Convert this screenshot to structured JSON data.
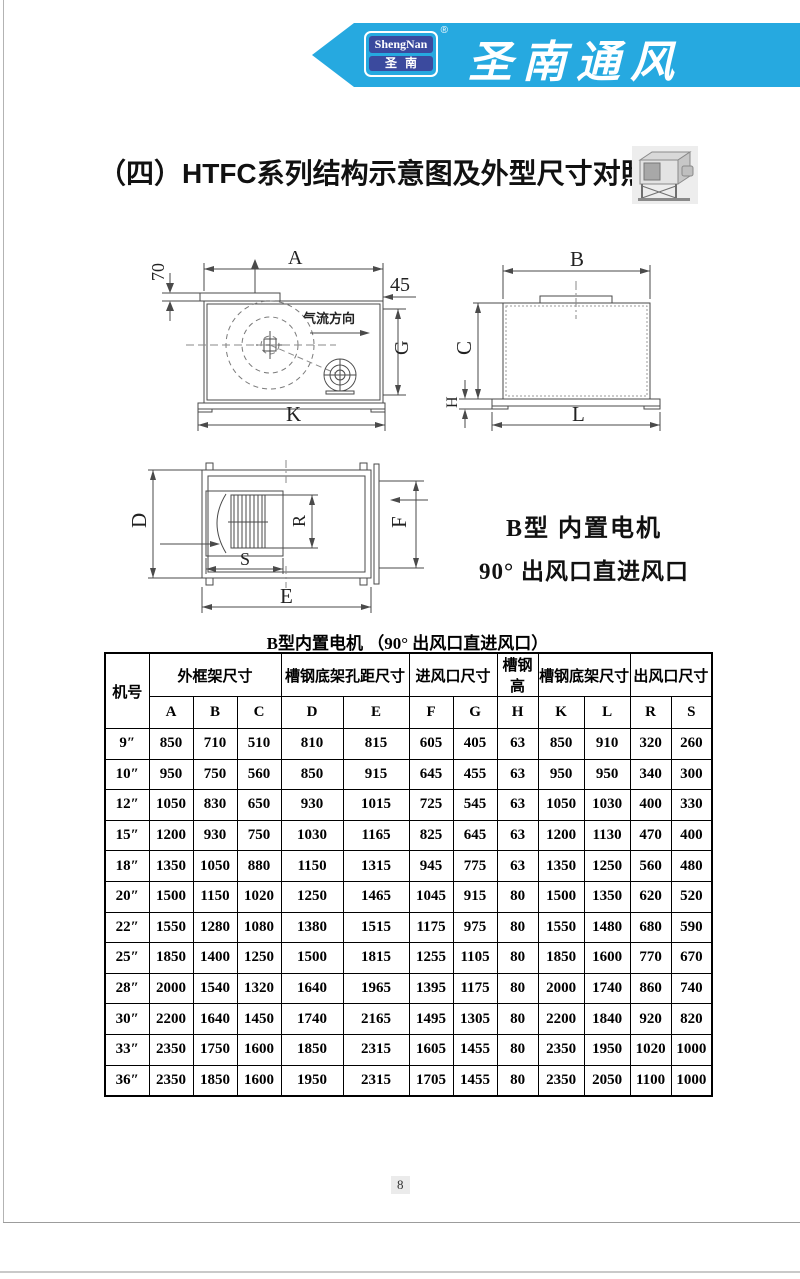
{
  "header": {
    "banner_color": "#26a9e0",
    "logo": {
      "line1": "ShengNan",
      "line2": "圣南",
      "registered": "®",
      "box_color": "#3b4a9e"
    },
    "brand": "圣南通风"
  },
  "title": "（四）HTFC系列结构示意图及外型尺寸对照表",
  "diagrams": {
    "side_view": {
      "dim_top": "A",
      "dim_flange": "70",
      "dim_outlet_gap": "45",
      "dim_right": "G",
      "dim_bottom": "K",
      "airflow": "气流方向"
    },
    "front_view": {
      "dim_top": "B",
      "dim_left": "C",
      "dim_base": "H",
      "dim_bottom": "L"
    },
    "plan_view": {
      "dim_left": "D",
      "dim_wheel_h": "R",
      "dim_wheel_w": "S",
      "dim_right": "F",
      "dim_bottom": "E"
    },
    "type_note_line1": "B型  内置电机",
    "type_note_line2": "90° 出风口直进风口"
  },
  "table": {
    "title": "B型内置电机 （90° 出风口直进风口）",
    "col_machine": "机号",
    "groups": [
      {
        "label": "外框架尺寸",
        "span": 3
      },
      {
        "label": "槽钢底架孔距尺寸",
        "span": 2
      },
      {
        "label": "进风口尺寸",
        "span": 2
      },
      {
        "label": "槽钢高",
        "span": 1
      },
      {
        "label": "槽钢底架尺寸",
        "span": 2
      },
      {
        "label": "出风口尺寸",
        "span": 2
      }
    ],
    "letters": [
      "A",
      "B",
      "C",
      "D",
      "E",
      "F",
      "G",
      "H",
      "K",
      "L",
      "R",
      "S"
    ],
    "rows": [
      {
        "model": "9″",
        "values": [
          "850",
          "710",
          "510",
          "810",
          "815",
          "605",
          "405",
          "63",
          "850",
          "910",
          "320",
          "260"
        ]
      },
      {
        "model": "10″",
        "values": [
          "950",
          "750",
          "560",
          "850",
          "915",
          "645",
          "455",
          "63",
          "950",
          "950",
          "340",
          "300"
        ]
      },
      {
        "model": "12″",
        "values": [
          "1050",
          "830",
          "650",
          "930",
          "1015",
          "725",
          "545",
          "63",
          "1050",
          "1030",
          "400",
          "330"
        ]
      },
      {
        "model": "15″",
        "values": [
          "1200",
          "930",
          "750",
          "1030",
          "1165",
          "825",
          "645",
          "63",
          "1200",
          "1130",
          "470",
          "400"
        ]
      },
      {
        "model": "18″",
        "values": [
          "1350",
          "1050",
          "880",
          "1150",
          "1315",
          "945",
          "775",
          "63",
          "1350",
          "1250",
          "560",
          "480"
        ]
      },
      {
        "model": "20″",
        "values": [
          "1500",
          "1150",
          "1020",
          "1250",
          "1465",
          "1045",
          "915",
          "80",
          "1500",
          "1350",
          "620",
          "520"
        ]
      },
      {
        "model": "22″",
        "values": [
          "1550",
          "1280",
          "1080",
          "1380",
          "1515",
          "1175",
          "975",
          "80",
          "1550",
          "1480",
          "680",
          "590"
        ]
      },
      {
        "model": "25″",
        "values": [
          "1850",
          "1400",
          "1250",
          "1500",
          "1815",
          "1255",
          "1105",
          "80",
          "1850",
          "1600",
          "770",
          "670"
        ]
      },
      {
        "model": "28″",
        "values": [
          "2000",
          "1540",
          "1320",
          "1640",
          "1965",
          "1395",
          "1175",
          "80",
          "2000",
          "1740",
          "860",
          "740"
        ]
      },
      {
        "model": "30″",
        "values": [
          "2200",
          "1640",
          "1450",
          "1740",
          "2165",
          "1495",
          "1305",
          "80",
          "2200",
          "1840",
          "920",
          "820"
        ]
      },
      {
        "model": "33″",
        "values": [
          "2350",
          "1750",
          "1600",
          "1850",
          "2315",
          "1605",
          "1455",
          "80",
          "2350",
          "1950",
          "1020",
          "1000"
        ]
      },
      {
        "model": "36″",
        "values": [
          "2350",
          "1850",
          "1600",
          "1950",
          "2315",
          "1705",
          "1455",
          "80",
          "2350",
          "2050",
          "1100",
          "1000"
        ]
      }
    ]
  },
  "footer": {
    "page_number": "8"
  }
}
